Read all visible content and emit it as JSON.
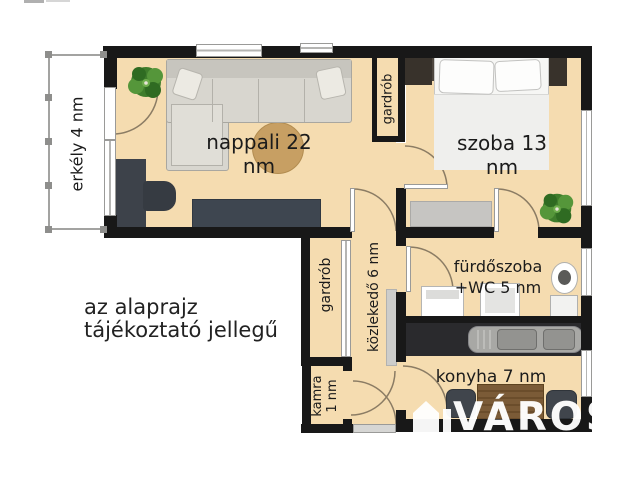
{
  "floorplan": {
    "rooms": {
      "nappali": {
        "label": "nappali 22 nm"
      },
      "szoba": {
        "label": "szoba 13 nm"
      },
      "erkely": {
        "label": "erkély 4 nm"
      },
      "gardrob_felso": {
        "label": "gardrób"
      },
      "gardrob_also": {
        "label": "gardrób"
      },
      "kozlekedo": {
        "label": "közlekedő 6 nm"
      },
      "furdoszoba": {
        "label_line1": "fürdőszoba",
        "label_line2": "+WC 5 nm"
      },
      "konyha": {
        "label": "konyha 7 nm"
      },
      "kamra": {
        "label_line1": "kamra",
        "label_line2": "1 nm"
      }
    },
    "disclaimer": {
      "line1": "az alaprajz",
      "line2": "tájékoztató jellegű"
    },
    "watermark": {
      "text": "VÁROS"
    },
    "colors": {
      "floor": "#f5dcb0",
      "wall": "#181818",
      "rug": "#c79f63",
      "sofa": "#d8d6cf",
      "table": "#7b5b37",
      "counter": "#2a2a2d"
    }
  }
}
